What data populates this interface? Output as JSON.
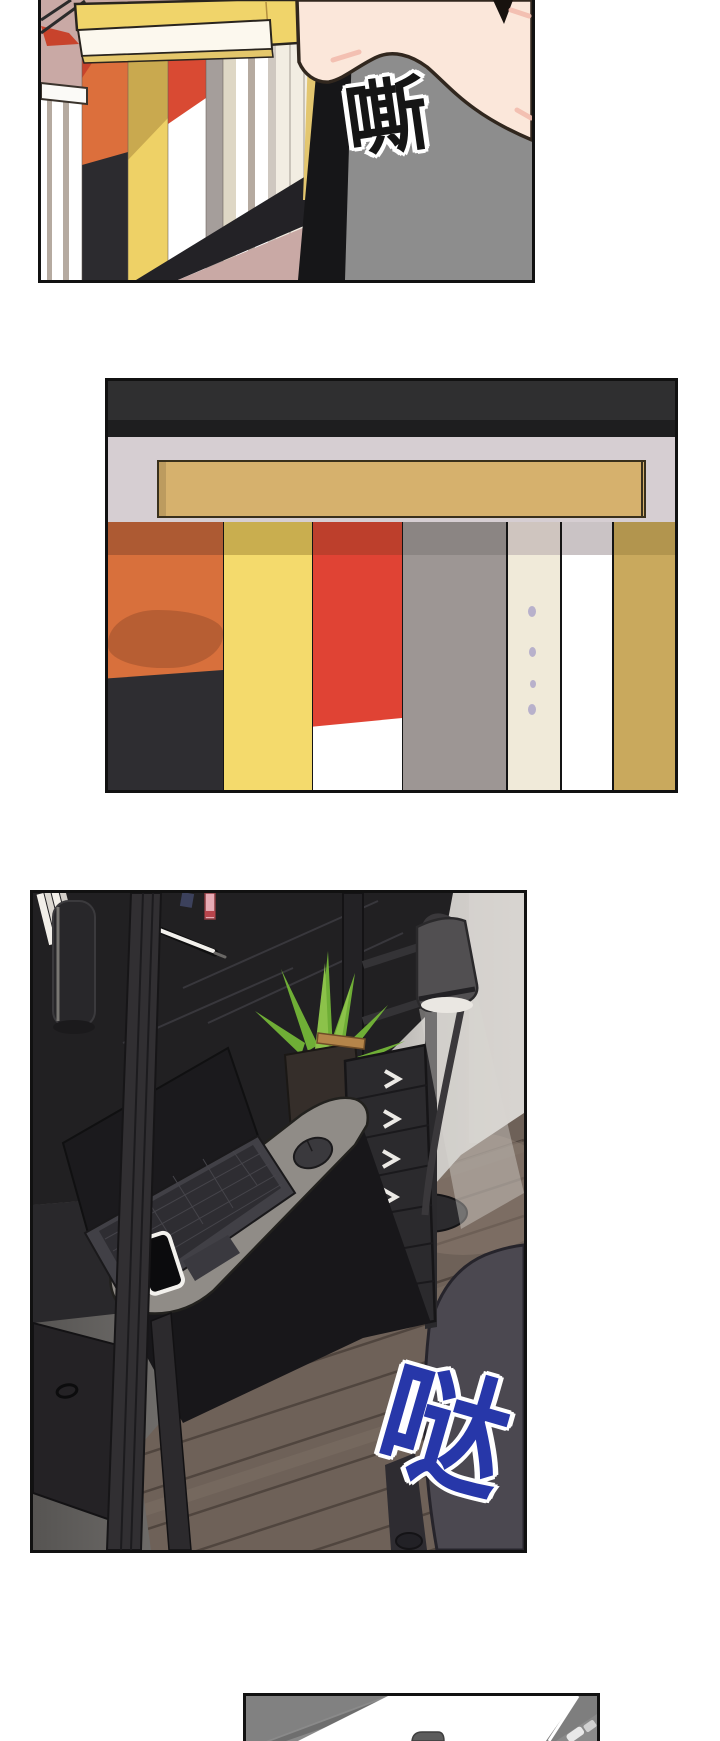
{
  "page": {
    "width": 720,
    "height": 1741,
    "background": "#ffffff",
    "panel_border": "#111111"
  },
  "sfx": [
    {
      "text": "嘶",
      "color": "#151515",
      "outline": "#ffffff"
    },
    {
      "text": "哒",
      "color": "#2737a9",
      "outline": "#ffffff"
    }
  ],
  "panels": [
    {
      "label": "panel-1",
      "alt": "Seen from below: a hand pulls a yellow book off a dark bookshelf; book spines hang in perspective; gray figure at right",
      "colors": {
        "wall": "#c9a9a5",
        "shelf_rail": "#232226",
        "shelf_bar": "#161618",
        "figure": "#8d8d8d",
        "skin": "#fbe7da",
        "blush": "#f3bcae",
        "hair": "#17120e",
        "pulled_book": "#f0d46a",
        "pulled_book_pages": "#fcf8ee",
        "pulled_book_edge": "#e4c76b",
        "orange_book": "#dc6f3c",
        "orange_book_base": "#2c2b2f",
        "yellow_book": "#eed166",
        "yellow_book_shadow": "#c9a94f",
        "red_book_top": "#d94a33",
        "white_band": "#fbfaf7",
        "red_smear": "#c8432c",
        "white_cluster": "#f2ede2"
      }
    },
    {
      "label": "panel-2",
      "alt": "Straight-on view of a row of book spines on a shelf under a dark frame",
      "colors": {
        "frame_top": "#2f2f30",
        "frame_top_dark": "#1e1e1f",
        "wall": "#d6ced2",
        "board": "#d6b16d",
        "board_edge": "#39301c"
      },
      "books": [
        {
          "face": "#d8703c",
          "top": "#ad5a33",
          "smear": "#b25a31",
          "bottom": "#2e2d31"
        },
        {
          "face": "#f4da6c",
          "top": "#c9ae4f"
        },
        {
          "face": "#e04334",
          "top": "#bd3f2c",
          "bottom": "#ffffff"
        },
        {
          "face": "#9d9694",
          "top": "#8b8583"
        },
        {
          "face": "#f0ead9",
          "top": "#cfc5bf",
          "dots": "#b8b1cb"
        },
        {
          "face": "#ffffff",
          "top": "#cac3c5"
        },
        {
          "face": "#c9a95d",
          "top": "#b2954e"
        }
      ]
    },
    {
      "label": "panel-3",
      "alt": "Dark loft desk at night: laptop, mouse and phone on a gray desk pad, drawer tower, potted aloe plant, glowing floor lamp, wood floor, office chair",
      "colors": {
        "desk": "#212022",
        "desk_pad": "#908c87",
        "laptop_lid": "#1b1a1d",
        "laptop_body": "#414046",
        "laptop_keys": "#2e2d32",
        "phone_frame": "#f3f1ed",
        "phone_screen": "#0b0b0d",
        "mouse": "#3a393d",
        "plant_green": "#6fae36",
        "plant_green_light": "#8cc24a",
        "pot": "#352e2a",
        "pot_stick": "#b5854a",
        "lamp_shade": "#514f51",
        "lamp_glow": "#eae7e2",
        "lamp_pole": "#3a383b",
        "wall_dark": "#565452",
        "wall_lit": "#d6d3cf",
        "floor": "#6e6158",
        "floor_seam": "#4c433c",
        "drawers": "#2b2a2d",
        "drawer_handle": "#eceae6",
        "chair": "#4b4850",
        "cabinet": "#242225",
        "post": "#312f32"
      }
    },
    {
      "label": "panel-4",
      "alt": "Partial overhead panel: white papers on a gray desk",
      "colors": {
        "background": "#8a8a8a",
        "paper": "#ffffff",
        "shadow": "#6e6e6e",
        "wedge": "#7e7e7e",
        "tab": "#5c5c5c"
      }
    }
  ]
}
